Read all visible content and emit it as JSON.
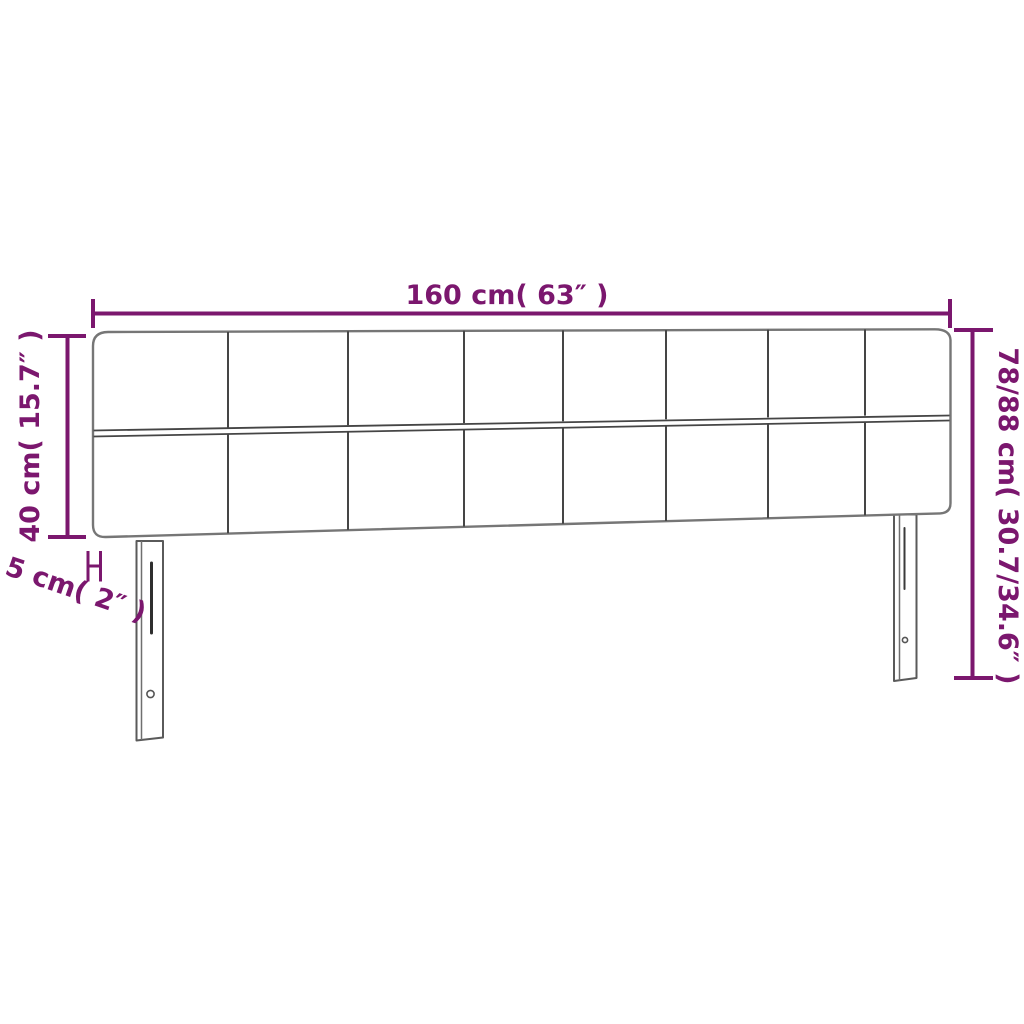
{
  "diagram": {
    "title": "headboard-dimension-diagram",
    "product": "upholstered headboard with legs",
    "labels": {
      "width": "160 cm( 63″ )",
      "total_height": "78/88 cm( 30.7/34.6″ )",
      "panel_height": "40 cm( 15.7″ )",
      "thickness": "5 cm( 2″ )"
    },
    "structure": {
      "tufted_rows": 2,
      "tufted_columns": 8,
      "legs": 2
    }
  },
  "colors": {
    "dimension": "#7b176e",
    "outline": "#767676",
    "seam": "#454545",
    "background": "#ffffff"
  }
}
